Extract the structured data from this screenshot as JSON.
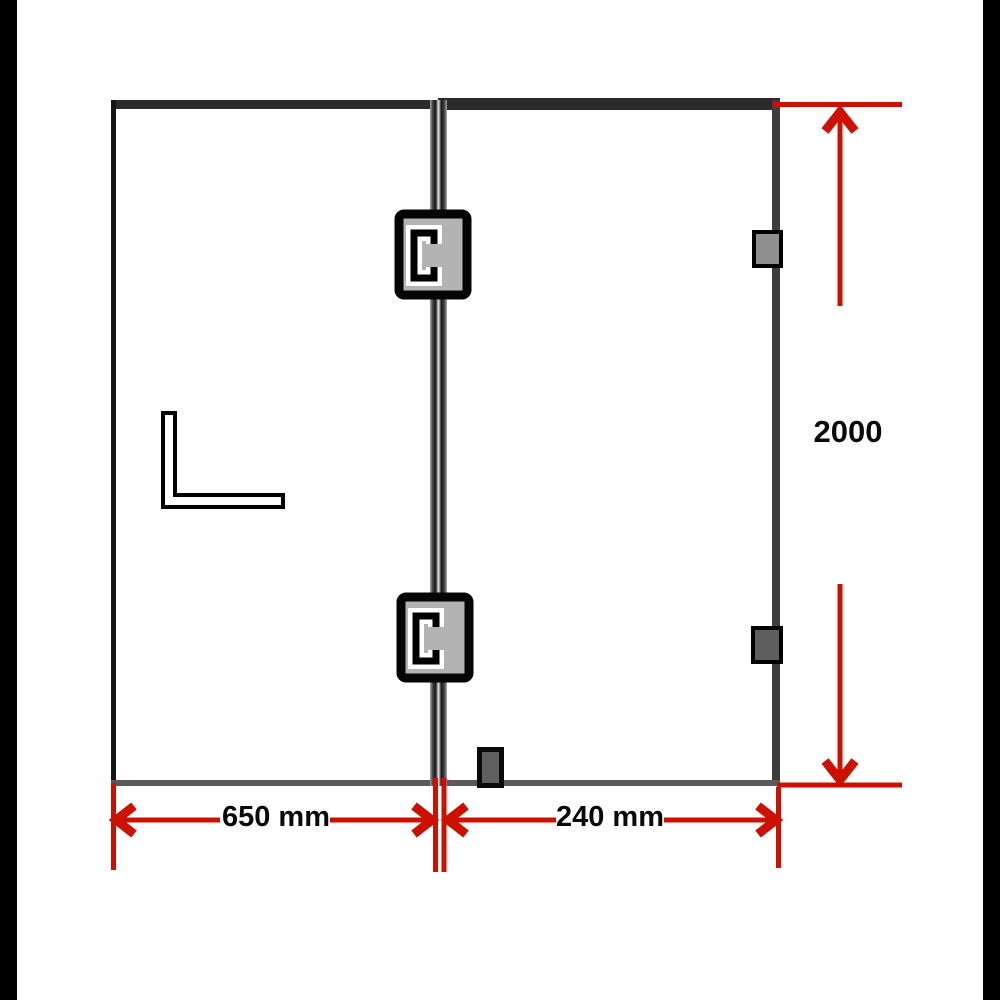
{
  "diagram": {
    "type": "product-dimension-diagram",
    "subject": "glass shower screen with fixed panel and hinged door"
  },
  "dimensions": {
    "left_panel_width": {
      "label": "650 mm"
    },
    "door_width": {
      "label": "240 mm"
    },
    "height": {
      "label": "2000"
    }
  },
  "components": [
    "hinge-top",
    "hinge-bottom",
    "wall-bracket-top",
    "wall-bracket-bottom",
    "door-stopper",
    "angle-bracket",
    "fixed-panel",
    "door-panel",
    "center-divider"
  ],
  "colors": {
    "accent_red": "#cc1100",
    "frame_dark": "#2b2b2b",
    "frame_medium": "#3d3d3d",
    "frame_light_gray": "#5a5a5a",
    "edge_black": "#151515",
    "hinge_fill": "#b3b3b3",
    "bracket_light": "#8f8f8f",
    "bracket_dark": "#5e5e5e",
    "stopper_fill": "#606060",
    "side_bar": "#000000",
    "label_color": "#0a0a0a"
  }
}
